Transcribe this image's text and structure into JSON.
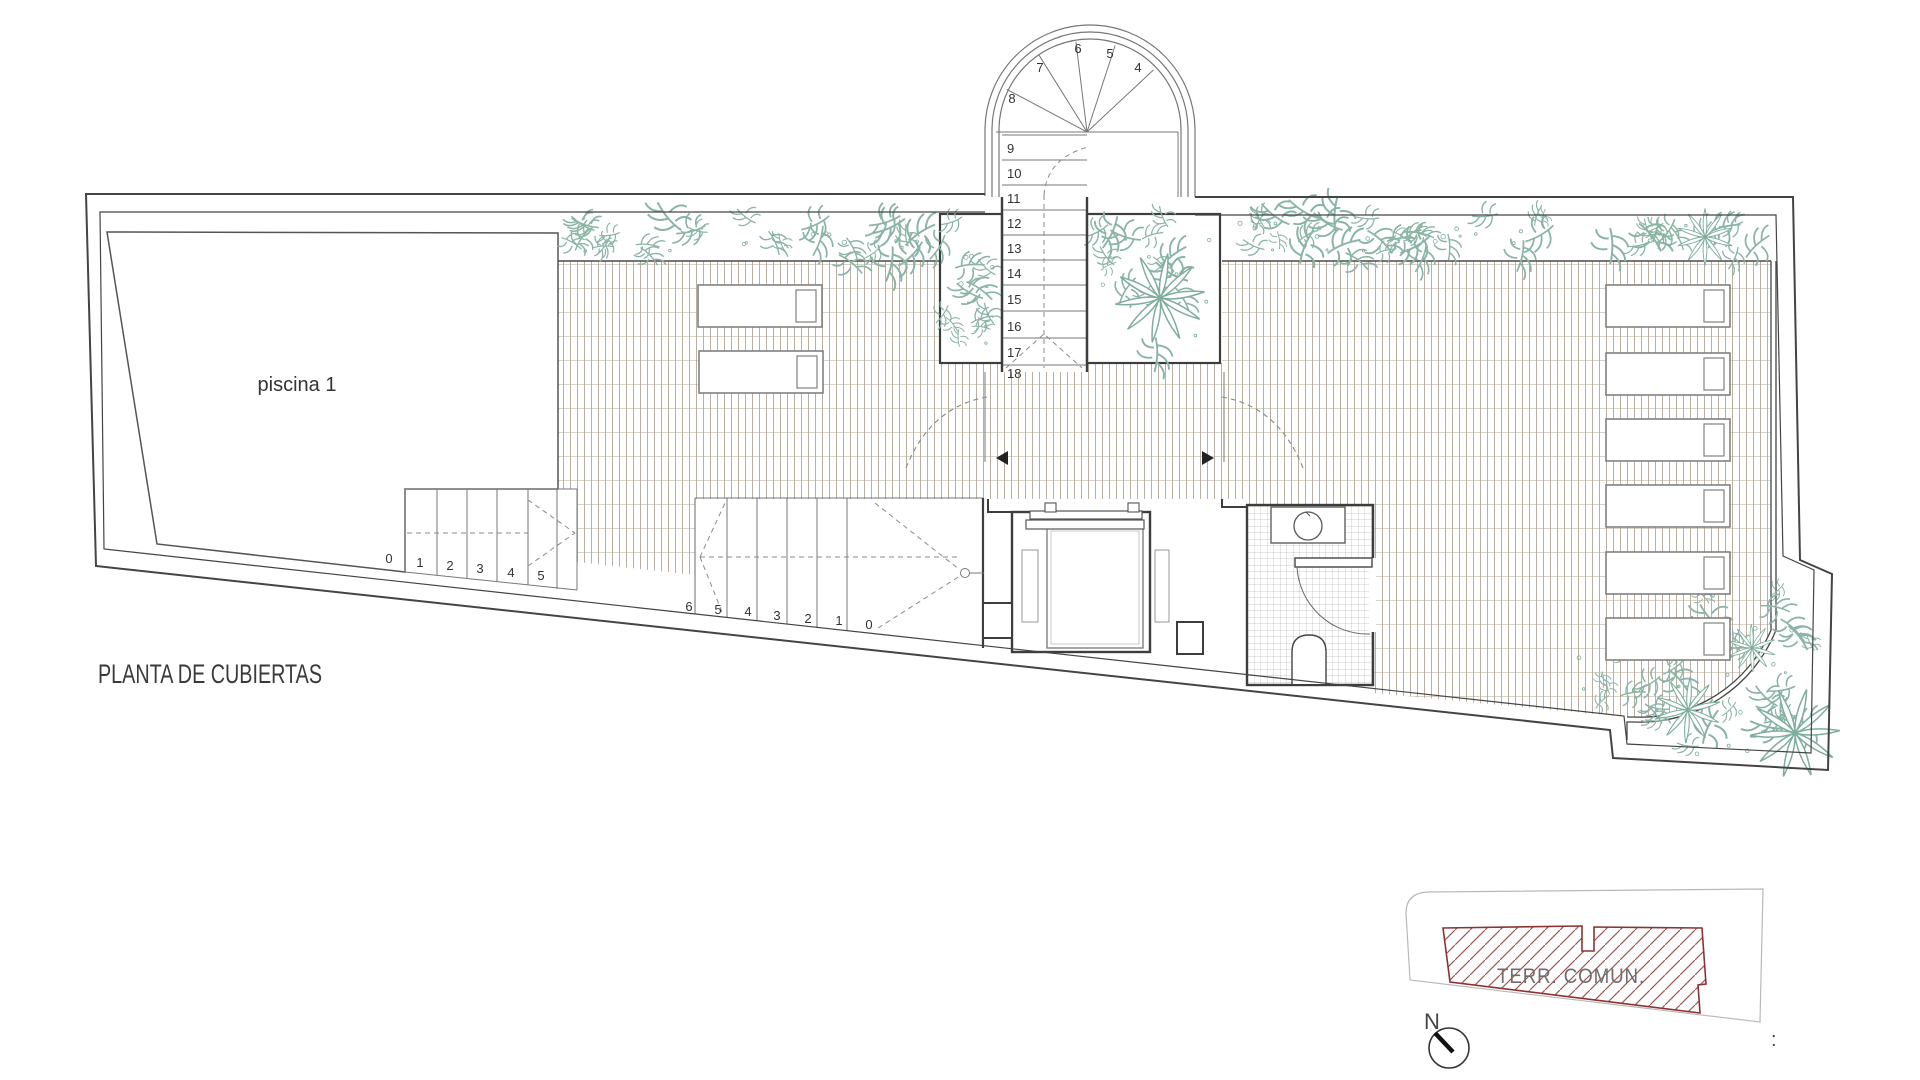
{
  "title": "PLANTA DE CUBIERTAS",
  "pool_label": "piscina 1",
  "keyplan": {
    "area_label": "TERR. COMUN.",
    "north_label": "N",
    "separator": ":"
  },
  "spiral_stair": {
    "winder_numbers": [
      "4",
      "5",
      "6",
      "7",
      "8"
    ],
    "flight_numbers": [
      "9",
      "10",
      "11",
      "12",
      "13",
      "14",
      "15",
      "16",
      "17",
      "18"
    ]
  },
  "pool_stair_numbers": [
    "0",
    "1",
    "2",
    "3",
    "4",
    "5"
  ],
  "terrace_stair_numbers": [
    "6",
    "5",
    "4",
    "3",
    "2",
    "1",
    "0"
  ],
  "colors": {
    "wall": "#444444",
    "deck_hatch": "#b3a697",
    "deck_hatch_cross": "#cfc7ba",
    "plant_green": "#8ab4a4",
    "red_zone": "#8b3333",
    "text": "#3a3a3a",
    "keyplan_outline": "#b9b9b9"
  }
}
